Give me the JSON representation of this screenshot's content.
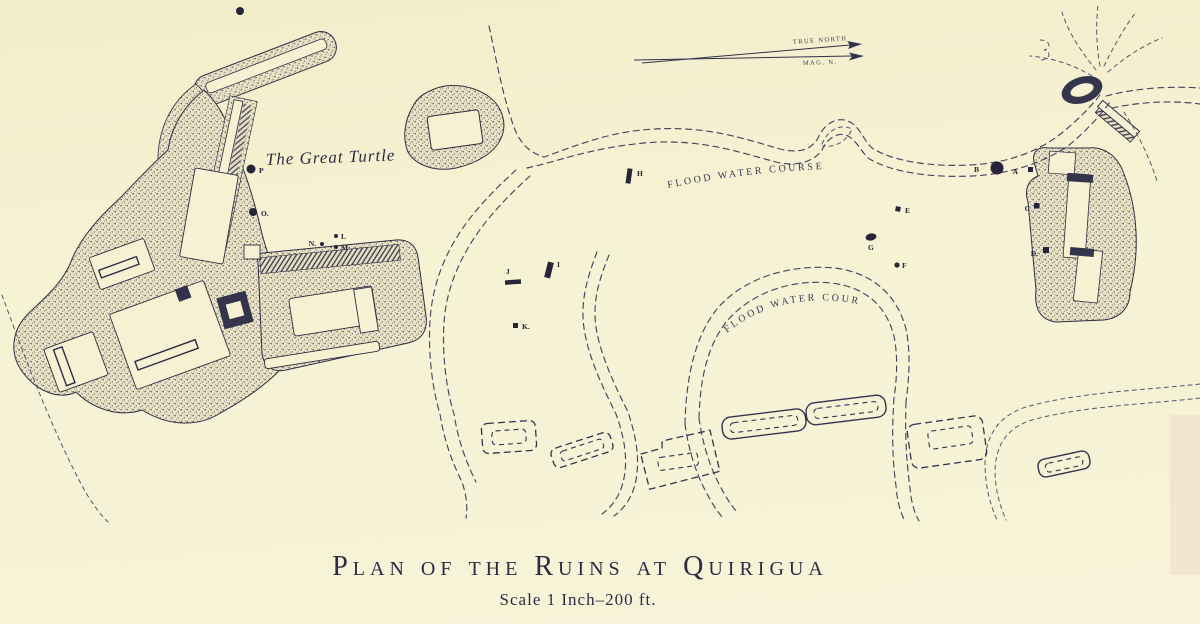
{
  "map": {
    "type": "antique-site-plan",
    "palette": {
      "paper": "#f5f1d2",
      "ink": "#2e2d44",
      "dash_ink": "#46455f"
    },
    "title": {
      "main": "Plan of the Ruins at Quirigua",
      "scale": "Scale 1 Inch–200 ft."
    },
    "north_arrow": {
      "true_label": "TRUE  NORTH",
      "magnetic_label": "MAG. N."
    },
    "labels": {
      "great_turtle": "The Great Turtle",
      "flood_course_upper": "FLOOD WATER COURSE",
      "flood_course_lower": "FLOOD WATER COURSE"
    },
    "monuments": [
      {
        "letter": "A",
        "marker": "small-square"
      },
      {
        "letter": "B",
        "marker": "large-dot"
      },
      {
        "letter": "C",
        "marker": "small-square"
      },
      {
        "letter": "D.",
        "marker": "small-square"
      },
      {
        "letter": "E",
        "marker": "small-square"
      },
      {
        "letter": "F",
        "marker": "dot"
      },
      {
        "letter": "G",
        "marker": "oval-dot"
      },
      {
        "letter": "H",
        "marker": "bar"
      },
      {
        "letter": "I",
        "marker": "bar"
      },
      {
        "letter": "J",
        "marker": "bar"
      },
      {
        "letter": "K.",
        "marker": "square-dot"
      },
      {
        "letter": "L",
        "marker": "dot"
      },
      {
        "letter": "M",
        "marker": "dot"
      },
      {
        "letter": "N.",
        "marker": "dot"
      },
      {
        "letter": "O.",
        "marker": "dot"
      },
      {
        "letter": "P",
        "marker": "dot"
      }
    ],
    "features": [
      "acropolis-complex",
      "long-mound",
      "causeway",
      "pyramid-mound",
      "east-group-mound",
      "ring-mound",
      "bar-mound",
      "upper-flood-water-course",
      "lower-flood-water-course",
      "stream-branches",
      "plaza-mounds"
    ]
  }
}
